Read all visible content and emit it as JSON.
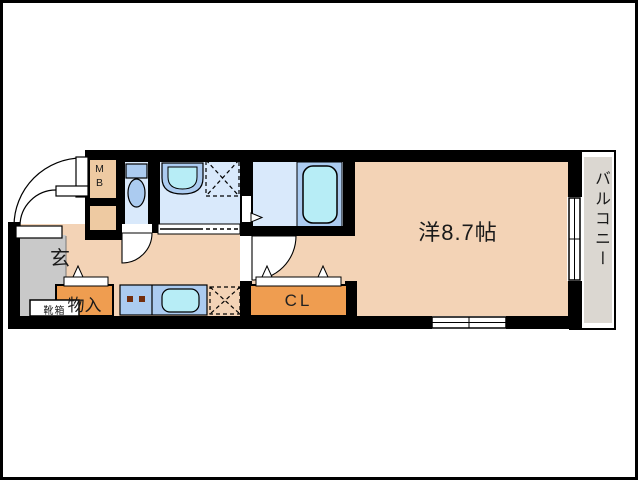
{
  "labels": {
    "main_room": "洋8.7帖",
    "balcony": "バルコニー",
    "entrance": "玄",
    "shoe_box": "靴箱",
    "storage": "物入",
    "closet": "CL",
    "meter_box": "MB"
  },
  "colors": {
    "wall": "#000000",
    "room_floor": "#f3d3b6",
    "entrance_floor": "#c9c9c9",
    "wet_area_floor": "#d9e9fb",
    "fixture_blue": "#abcbf0",
    "water_cyan": "#b7edf6",
    "closet_orange": "#ef9d50",
    "meter_box_tan": "#eecaa2",
    "balcony_gray": "#dbd7d1",
    "burner_brown": "#722d0e"
  }
}
